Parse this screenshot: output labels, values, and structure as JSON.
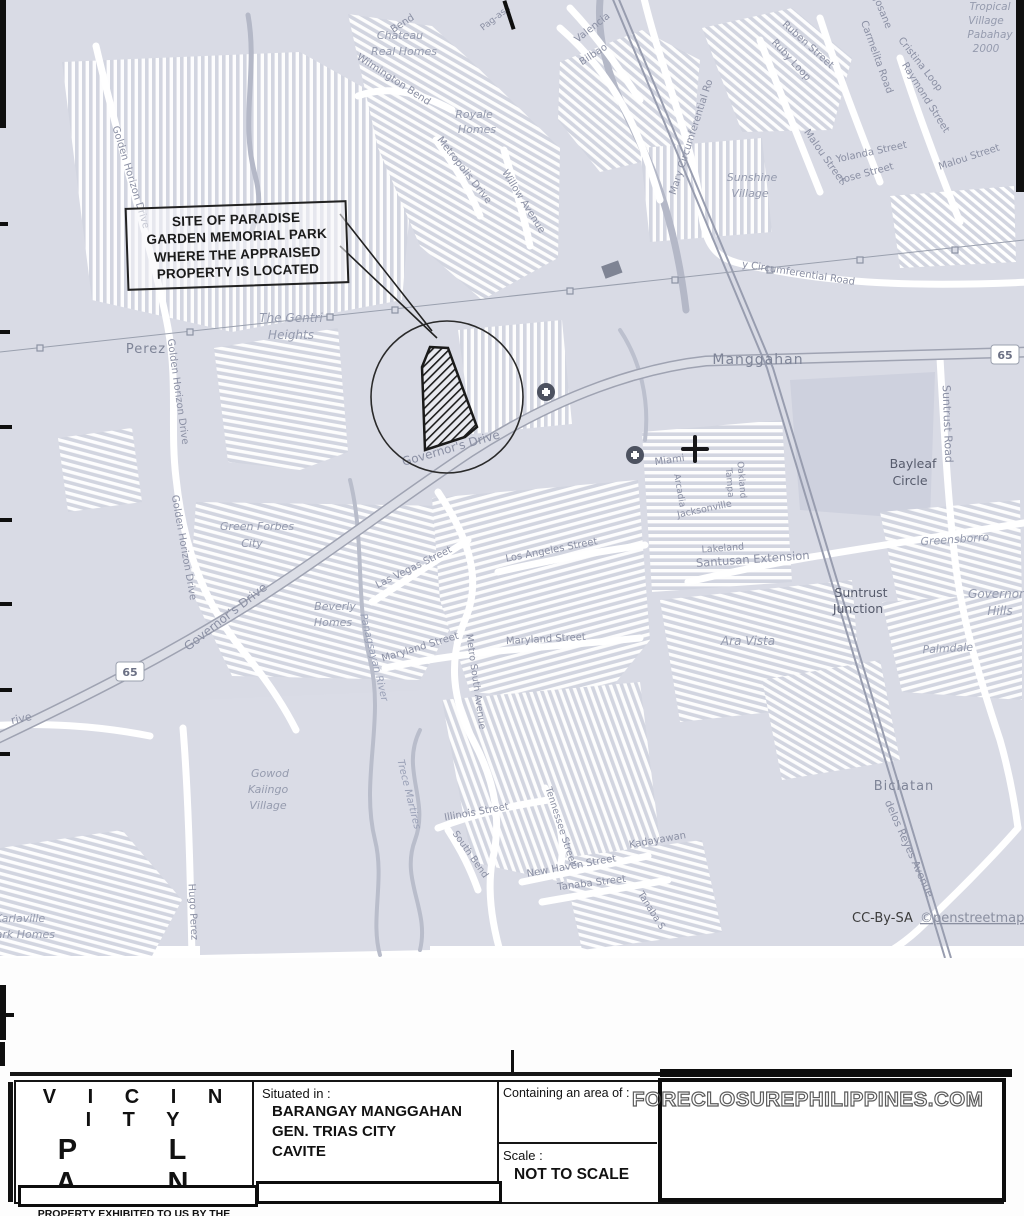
{
  "map": {
    "annotation": {
      "lines": [
        "SITE OF PARADISE",
        "GARDEN MEMORIAL PARK",
        "WHERE THE APPRAISED",
        "PROPERTY IS LOCATED"
      ]
    },
    "attribution": {
      "license": "CC-By-SA",
      "source": "©penstreetmap.org"
    },
    "route_shields": [
      {
        "t": "65",
        "x": 130,
        "y": 673
      },
      {
        "t": "65",
        "x": 1005,
        "y": 356
      }
    ],
    "labels": [
      {
        "t": "Bend",
        "x": 404,
        "y": 26,
        "r": -33
      },
      {
        "t": "Pag-asa",
        "x": 497,
        "y": 20,
        "r": -38,
        "s": 9
      },
      {
        "t": "Wilmington Bend",
        "x": 392,
        "y": 82,
        "r": 33
      },
      {
        "t": "Metropolis Drive",
        "x": 462,
        "y": 172,
        "r": 52
      },
      {
        "t": "Willow Avenue",
        "x": 521,
        "y": 203,
        "r": 58
      },
      {
        "t": "Golden Horizon Drive",
        "x": 128,
        "y": 178,
        "r": 73
      },
      {
        "t": "Golden Horizon Drive",
        "x": 175,
        "y": 392,
        "r": 82
      },
      {
        "t": "Golden Horizon Drive",
        "x": 181,
        "y": 548,
        "r": 80
      },
      {
        "t": "Valencia",
        "x": 594,
        "y": 30,
        "r": -38
      },
      {
        "t": "Bilbao",
        "x": 595,
        "y": 57,
        "r": -33
      },
      {
        "t": "Mary Circumferential Ro",
        "x": 694,
        "y": 138,
        "r": -72
      },
      {
        "t": "y Circumferential Road",
        "x": 798,
        "y": 276,
        "r": 9
      },
      {
        "t": "Josane",
        "x": 880,
        "y": 14,
        "r": 68
      },
      {
        "t": "Ruben Street",
        "x": 806,
        "y": 47,
        "r": 42
      },
      {
        "t": "Ruby Loop",
        "x": 789,
        "y": 62,
        "r": 47
      },
      {
        "t": "Carmelita Road",
        "x": 874,
        "y": 58,
        "r": 70
      },
      {
        "t": "Cristina Loop",
        "x": 918,
        "y": 66,
        "r": 52
      },
      {
        "t": "Raymond Street",
        "x": 923,
        "y": 99,
        "r": 58
      },
      {
        "t": "Yolanda Street",
        "x": 872,
        "y": 155,
        "r": -12
      },
      {
        "t": "Jose Street",
        "x": 868,
        "y": 176,
        "r": -15
      },
      {
        "t": "Malou Street",
        "x": 822,
        "y": 158,
        "r": 55
      },
      {
        "t": "Malou Street",
        "x": 970,
        "y": 160,
        "r": -18
      },
      {
        "t": "Suntrust Road",
        "x": 944,
        "y": 424,
        "r": 88,
        "s": 11
      },
      {
        "t": "Miami",
        "x": 670,
        "y": 463,
        "r": -8
      },
      {
        "t": "Arcadia",
        "x": 677,
        "y": 491,
        "r": 80,
        "s": 9
      },
      {
        "t": "Tampa",
        "x": 727,
        "y": 483,
        "r": 85,
        "s": 9
      },
      {
        "t": "Oakland",
        "x": 739,
        "y": 480,
        "r": 85,
        "s": 9
      },
      {
        "t": "Jacksonville",
        "x": 705,
        "y": 512,
        "r": -12,
        "s": 9.5
      },
      {
        "t": "Lakeland",
        "x": 723,
        "y": 551,
        "r": -4,
        "s": 9.5
      },
      {
        "t": "Santusan Extension",
        "x": 753,
        "y": 563,
        "r": -4,
        "s": 11.5
      },
      {
        "t": "Las Vegas Street",
        "x": 415,
        "y": 570,
        "r": -26
      },
      {
        "t": "Los Angeles Street",
        "x": 552,
        "y": 553,
        "r": -11
      },
      {
        "t": "Maryland Street",
        "x": 421,
        "y": 650,
        "r": -17
      },
      {
        "t": "Maryland Street",
        "x": 546,
        "y": 642,
        "r": -3
      },
      {
        "t": "Metro South Avenue",
        "x": 473,
        "y": 682,
        "r": 82,
        "s": 9.5
      },
      {
        "t": "Governor's Drive",
        "x": 452,
        "y": 452,
        "r": -16,
        "s": 12
      },
      {
        "t": "Governor's Drive",
        "x": 228,
        "y": 620,
        "r": -38,
        "s": 12
      },
      {
        "t": "Illinois Street",
        "x": 477,
        "y": 815,
        "r": -10
      },
      {
        "t": "South Bend",
        "x": 468,
        "y": 856,
        "r": 55,
        "s": 9.5
      },
      {
        "t": "Tennessee Street",
        "x": 558,
        "y": 827,
        "r": 72,
        "s": 9.5
      },
      {
        "t": "New Haven Street",
        "x": 572,
        "y": 869,
        "r": -10
      },
      {
        "t": "Tanaba Street",
        "x": 592,
        "y": 886,
        "r": -7
      },
      {
        "t": "Tanaba S",
        "x": 649,
        "y": 912,
        "r": 58,
        "s": 9.5
      },
      {
        "t": "Kadayawan",
        "x": 658,
        "y": 843,
        "r": -10
      },
      {
        "t": "delos Reyes Avenue",
        "x": 906,
        "y": 850,
        "r": 66,
        "s": 10.5
      },
      {
        "t": "Hugo Perez",
        "x": 190,
        "y": 912,
        "r": 87
      },
      {
        "t": "rive",
        "x": 22,
        "y": 722,
        "r": -12,
        "s": 11
      },
      {
        "t": "Perez",
        "x": 146,
        "y": 353,
        "s": 13,
        "c": "pl"
      },
      {
        "t": "Manggahan",
        "x": 758,
        "y": 364,
        "s": 14,
        "c": "pl"
      },
      {
        "t": "Biclatan",
        "x": 904,
        "y": 790,
        "s": 13,
        "c": "pl"
      },
      {
        "t": "Suntrust",
        "x": 861,
        "y": 597,
        "s": 12.5,
        "c": "dk"
      },
      {
        "t": "Junction",
        "x": 858,
        "y": 613,
        "s": 12.5,
        "c": "dk"
      },
      {
        "t": "Bayleaf",
        "x": 913,
        "y": 468,
        "s": 12.5,
        "c": "dk"
      },
      {
        "t": "Circle",
        "x": 910,
        "y": 485,
        "s": 12.5,
        "c": "dk"
      },
      {
        "t": "Chateau",
        "x": 400,
        "y": 39,
        "s": 11,
        "c": "ar"
      },
      {
        "t": "Real Homes",
        "x": 404,
        "y": 55,
        "s": 11,
        "c": "ar"
      },
      {
        "t": "Royale",
        "x": 474,
        "y": 118,
        "s": 11,
        "c": "ar"
      },
      {
        "t": "Homes",
        "x": 477,
        "y": 133,
        "s": 11,
        "c": "ar"
      },
      {
        "t": "The Gentri",
        "x": 291,
        "y": 322,
        "s": 12,
        "c": "ar"
      },
      {
        "t": "Heights",
        "x": 291,
        "y": 339,
        "s": 12,
        "c": "ar"
      },
      {
        "t": "Sunshine",
        "x": 752,
        "y": 181,
        "s": 11,
        "c": "ar"
      },
      {
        "t": "Village",
        "x": 750,
        "y": 197,
        "s": 11,
        "c": "ar"
      },
      {
        "t": "Green Forbes",
        "x": 257,
        "y": 530,
        "s": 11,
        "c": "ar"
      },
      {
        "t": "City",
        "x": 252,
        "y": 547,
        "s": 11,
        "c": "ar"
      },
      {
        "t": "Beverly",
        "x": 335,
        "y": 610,
        "s": 11,
        "c": "ar"
      },
      {
        "t": "Homes",
        "x": 333,
        "y": 626,
        "s": 11,
        "c": "ar"
      },
      {
        "t": "Gowod",
        "x": 270,
        "y": 777,
        "s": 11,
        "c": "ar"
      },
      {
        "t": "Kaiingo",
        "x": 268,
        "y": 793,
        "s": 11,
        "c": "ar"
      },
      {
        "t": "Village",
        "x": 268,
        "y": 809,
        "s": 11,
        "c": "ar"
      },
      {
        "t": "Ara Vista",
        "x": 748,
        "y": 645,
        "s": 12,
        "c": "ar"
      },
      {
        "t": "Greensborro",
        "x": 955,
        "y": 543,
        "r": -4,
        "s": 11,
        "c": "ar"
      },
      {
        "t": "Governor",
        "x": 996,
        "y": 598,
        "s": 12,
        "c": "ar"
      },
      {
        "t": "Hills",
        "x": 1000,
        "y": 615,
        "s": 12,
        "c": "ar"
      },
      {
        "t": "Palmdale",
        "x": 948,
        "y": 652,
        "r": -3,
        "s": 11,
        "c": "ar"
      },
      {
        "t": "Tropical",
        "x": 990,
        "y": 10,
        "s": 10.5,
        "c": "ar"
      },
      {
        "t": "Village",
        "x": 986,
        "y": 24,
        "s": 10.5,
        "c": "ar"
      },
      {
        "t": "Pabahay",
        "x": 990,
        "y": 38,
        "s": 10.5,
        "c": "ar"
      },
      {
        "t": "2000",
        "x": 986,
        "y": 52,
        "s": 10.5,
        "c": "ar"
      },
      {
        "t": "Karlaville",
        "x": 20,
        "y": 922,
        "s": 11,
        "c": "ar"
      },
      {
        "t": "Park Homes",
        "x": 22,
        "y": 938,
        "s": 11,
        "c": "ar"
      },
      {
        "t": "Panagsayan River",
        "x": 371,
        "y": 658,
        "r": 76,
        "c": "wa"
      },
      {
        "t": "Trece Martires",
        "x": 406,
        "y": 795,
        "r": 76,
        "c": "wa"
      }
    ]
  },
  "title_block": {
    "title_line1": "V I C I N I T Y",
    "title_line2": "P L A N",
    "subtitle1": "PROPERTY EXHIBITED TO US BY THE",
    "subtitle2": "PHILIPPINES VETERANS BANK",
    "situated_label": "Situated in :",
    "situated_lines": [
      "BARANGAY MANGGAHAN",
      "GEN. TRIAS CITY",
      "CAVITE"
    ],
    "area_label": "Containing an area of :",
    "scale_label": "Scale :",
    "scale_value": "NOT TO SCALE",
    "watermark": "FORECLOSUREPHILIPPINES.COM"
  }
}
